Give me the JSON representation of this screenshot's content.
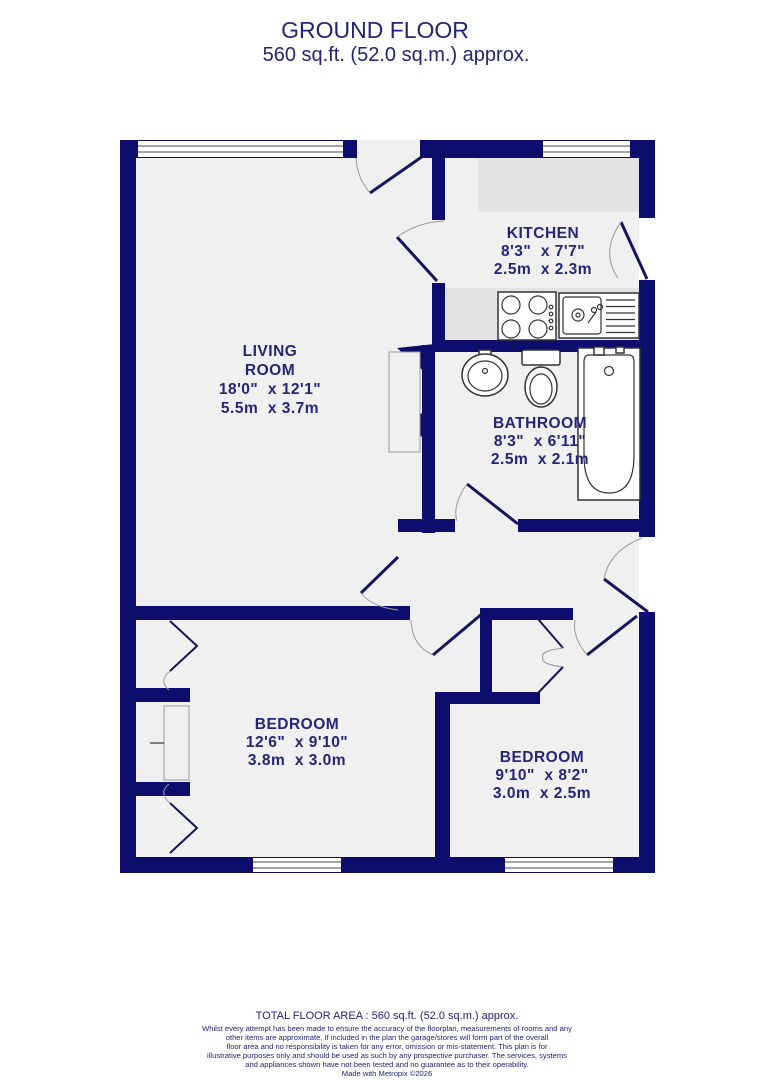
{
  "title": {
    "line1": "GROUND FLOOR",
    "line2": "560 sq.ft. (52.0 sq.m.) approx."
  },
  "rooms": {
    "living_room": {
      "name_line1": "LIVING",
      "name_line2": "ROOM",
      "dims_imperial": "18'0\"  x 12'1\"",
      "dims_metric": "5.5m  x 3.7m"
    },
    "kitchen": {
      "name": "KITCHEN",
      "dims_imperial": "8'3\"  x 7'7\"",
      "dims_metric": "2.5m  x 2.3m"
    },
    "bathroom": {
      "name": "BATHROOM",
      "dims_imperial": "8'3\"  x 6'11\"",
      "dims_metric": "2.5m  x 2.1m"
    },
    "bedroom_1": {
      "name": "BEDROOM",
      "dims_imperial": "12'6\"  x 9'10\"",
      "dims_metric": "3.8m  x 3.0m"
    },
    "bedroom_2": {
      "name": "BEDROOM",
      "dims_imperial": "9'10\"  x 8'2\"",
      "dims_metric": "3.0m  x 2.5m"
    }
  },
  "footer": {
    "total_area": "TOTAL FLOOR AREA : 560 sq.ft. (52.0 sq.m.) approx.",
    "disclaimer_lines": [
      "Whilst every attempt has been made to ensure the accuracy of the floorplan, measurements of rooms and any",
      "other items are approximate, If included in the plan the garage/stores will form part of the overall",
      "floor area and no responsibility is taken for any error, omission or mis-statement. This plan is for",
      "illustrative purposes only and should be used as such by any prospective purchaser. The services, systems",
      "and appliances shown have not been tested and no guarantee as to their operability."
    ],
    "credit": "Made with Metropix ©2026"
  },
  "colors": {
    "wall": "#0d0d6e",
    "label_text": "#24247a",
    "floor": "#f0f0f1",
    "worktop": "#e4e4e4"
  }
}
